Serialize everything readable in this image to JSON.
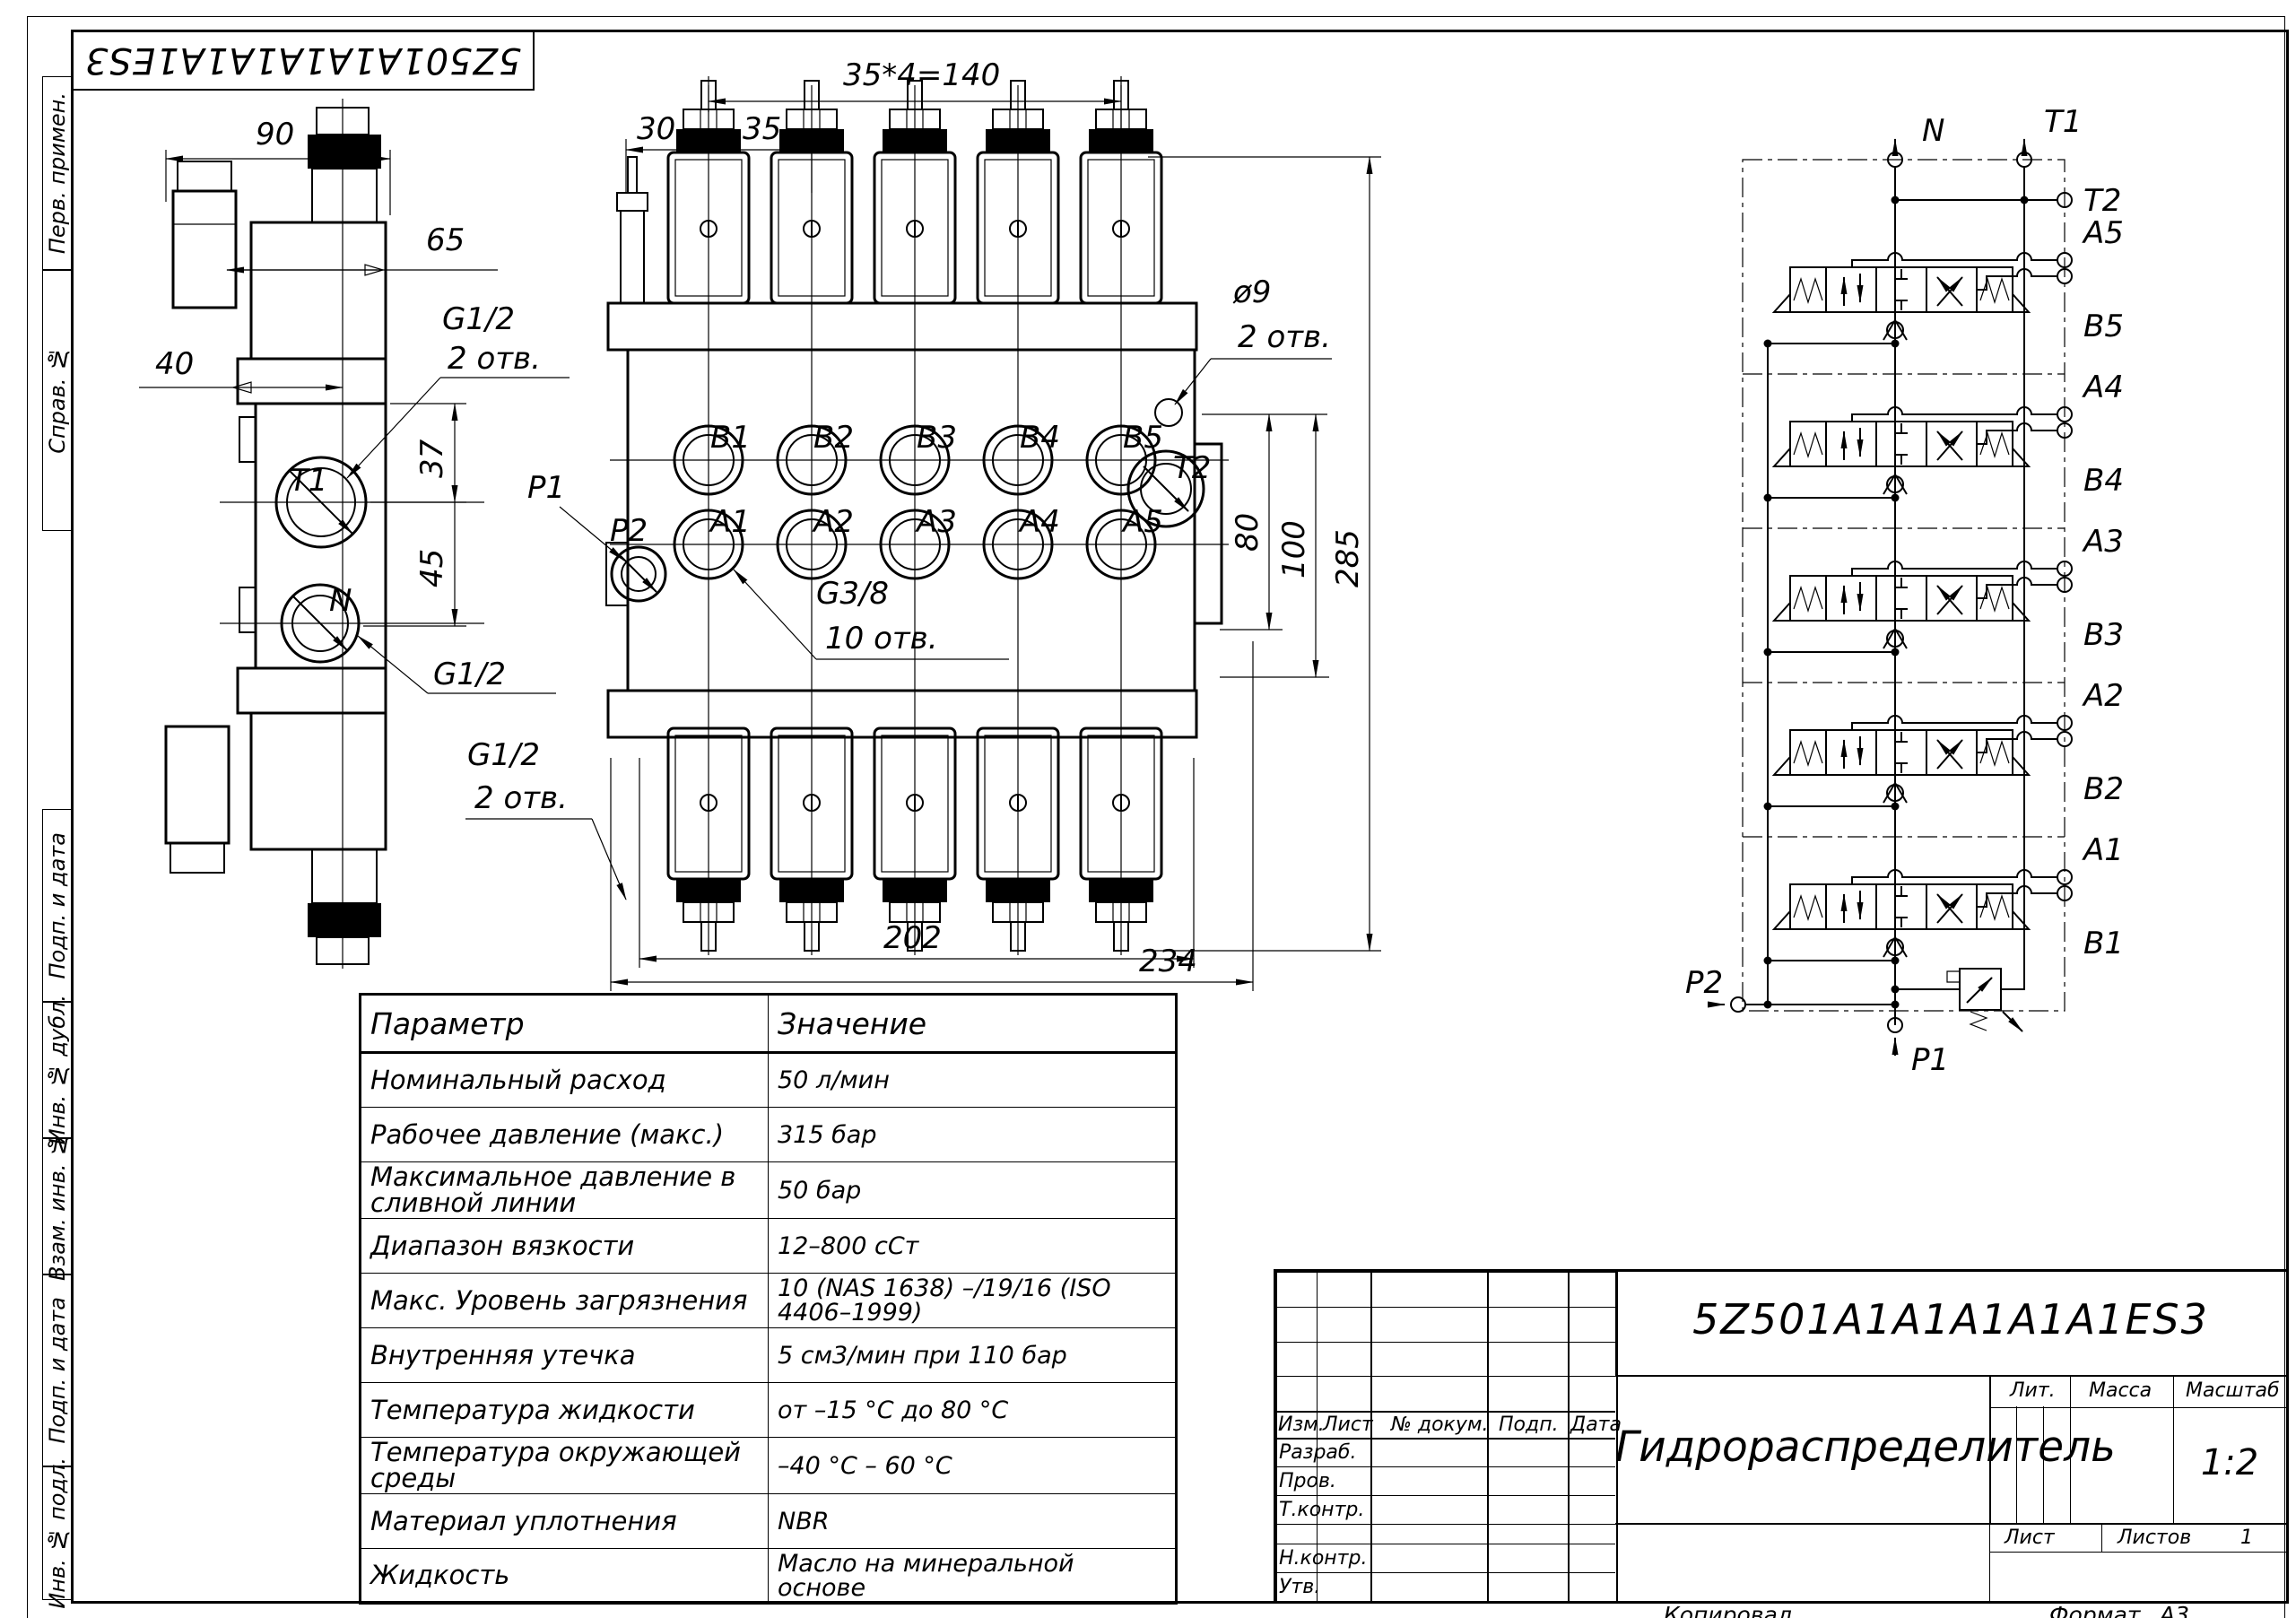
{
  "corner_stamp": {
    "designation": "5Z501A1A1A1A1A1ES3"
  },
  "margin": {
    "labels": [
      "Перв. примен.",
      "Справ. №",
      "Подп. и дата",
      "Инв. № дубл.",
      "Взам. инв. №",
      "Подп. и дата",
      "Инв. № подл."
    ]
  },
  "side_view": {
    "dim_90": "90",
    "dim_65": "65",
    "dim_40": "40",
    "dim_37": "37",
    "dim_45": "45",
    "g12_top": "G1/2",
    "g12_top_note": "2 отв.",
    "g12_mid": "G1/2",
    "g12_bottom": "G1/2",
    "g12_bottom_note": "2 отв.",
    "port_t1": "T1",
    "port_n": "N"
  },
  "front_view": {
    "dim_pitch": "35*4=140",
    "dim_30": "30",
    "dim_35": "35",
    "dia_note": "ø9",
    "dia_note2": "2 отв.",
    "dim_80": "80",
    "dim_100": "100",
    "dim_285": "285",
    "dim_202": "202",
    "dim_234": "234",
    "thread_note": "G3/8",
    "thread_note2": "10 отв.",
    "port_p1": "P1",
    "port_p2": "P2",
    "port_t2": "T2",
    "ports_b": [
      "B1",
      "B2",
      "B3",
      "B4",
      "B5"
    ],
    "ports_a": [
      "A1",
      "A2",
      "A3",
      "A4",
      "A5"
    ]
  },
  "schematic": {
    "n": "N",
    "t1": "T1",
    "t2": "T2",
    "p1": "P1",
    "p2": "P2",
    "sections": [
      {
        "a": "A5",
        "b": "B5"
      },
      {
        "a": "A4",
        "b": "B4"
      },
      {
        "a": "A3",
        "b": "B3"
      },
      {
        "a": "A2",
        "b": "B2"
      },
      {
        "a": "A1",
        "b": "B1"
      }
    ]
  },
  "table": {
    "col_param": "Параметр",
    "col_value": "Значение",
    "rows": [
      [
        "Номинальный расход",
        "50 л/мин"
      ],
      [
        "Рабочее давление (макс.)",
        "315 бар"
      ],
      [
        "Максимальное давление в сливной линии",
        "50 бар"
      ],
      [
        "Диапазон вязкости",
        "12–800 сСт"
      ],
      [
        "Макс. Уровень загрязнения",
        "10 (NAS 1638) –/19/16 (ISO 4406–1999)"
      ],
      [
        "Внутренняя утечка",
        "5 см3/мин при 110 бар"
      ],
      [
        "Температура жидкости",
        "от –15 °С до 80 °С"
      ],
      [
        "Температура окружающей среды",
        "–40 °С – 60 °С"
      ],
      [
        "Материал уплотнения",
        "NBR"
      ],
      [
        "Жидкость",
        "Масло на минеральной основе"
      ]
    ]
  },
  "title_block": {
    "designation": "5Z501A1A1A1A1A1ES3",
    "name": "Гидрораспределитель",
    "cols": {
      "izm": "Изм.",
      "list": "Лист",
      "ndoc": "№ докум.",
      "podp": "Подп.",
      "data": "Дата"
    },
    "rows": {
      "razrab": "Разраб.",
      "prov": "Пров.",
      "tkontr": "Т.контр.",
      "nkontr": "Н.контр.",
      "utv": "Утв."
    },
    "right": {
      "lit": "Лит.",
      "massa": "Масса",
      "masshtab": "Масштаб",
      "scale": "1:2",
      "list": "Лист",
      "listov": "Листов",
      "listov_value": "1"
    },
    "footer": {
      "kopiroval": "Копировал",
      "format": "Формат",
      "format_value": "А3"
    }
  }
}
